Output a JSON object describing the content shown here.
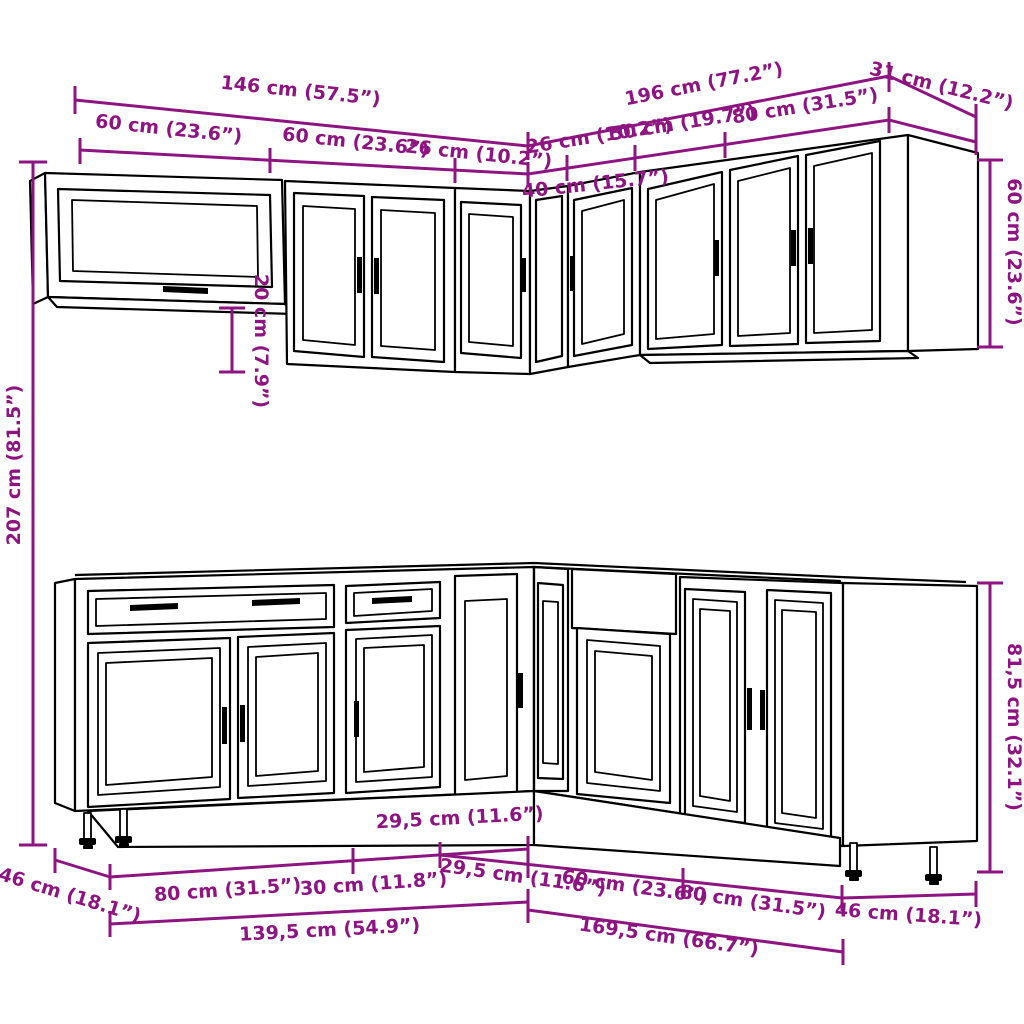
{
  "colors": {
    "dimension": "#8e1482",
    "line": "#000000",
    "background": "#ffffff"
  },
  "diagram": {
    "type": "kitchen-cabinet-set-dimension-drawing",
    "upper": {
      "width_left": "146 cm (57.5”)",
      "width_right": "196 cm (77.2”)",
      "side_depth": "31 cm (12.2”)",
      "segments_left": [
        "60 cm (23.6”)",
        "60 cm (23.6”)",
        "26 cm (10.2”)"
      ],
      "segments_right": [
        "26 cm (10.2”)",
        "50 cm (19.7”)",
        "80 cm (31.5”)"
      ],
      "corner_width": "40 cm (15.7”)",
      "cabinet_height": "60 cm (23.6”)",
      "bottom_offset": "20 cm (7.9”)"
    },
    "total_height": "207 cm (81.5”)",
    "base": {
      "depth_left": "46 cm (18.1”)",
      "segments_left": [
        "80 cm (31.5”)",
        "30 cm (11.8”)",
        "29,5 cm (11.6”)"
      ],
      "segments_right": [
        "29,5 cm (11.6”)",
        "60 cm (23.6”)",
        "80 cm (31.5”)"
      ],
      "depth_right": "46 cm (18.1”)",
      "width_left": "139,5 cm (54.9”)",
      "width_right": "169,5 cm (66.7”)",
      "cabinet_height": "81,5 cm (32.1”)"
    }
  }
}
